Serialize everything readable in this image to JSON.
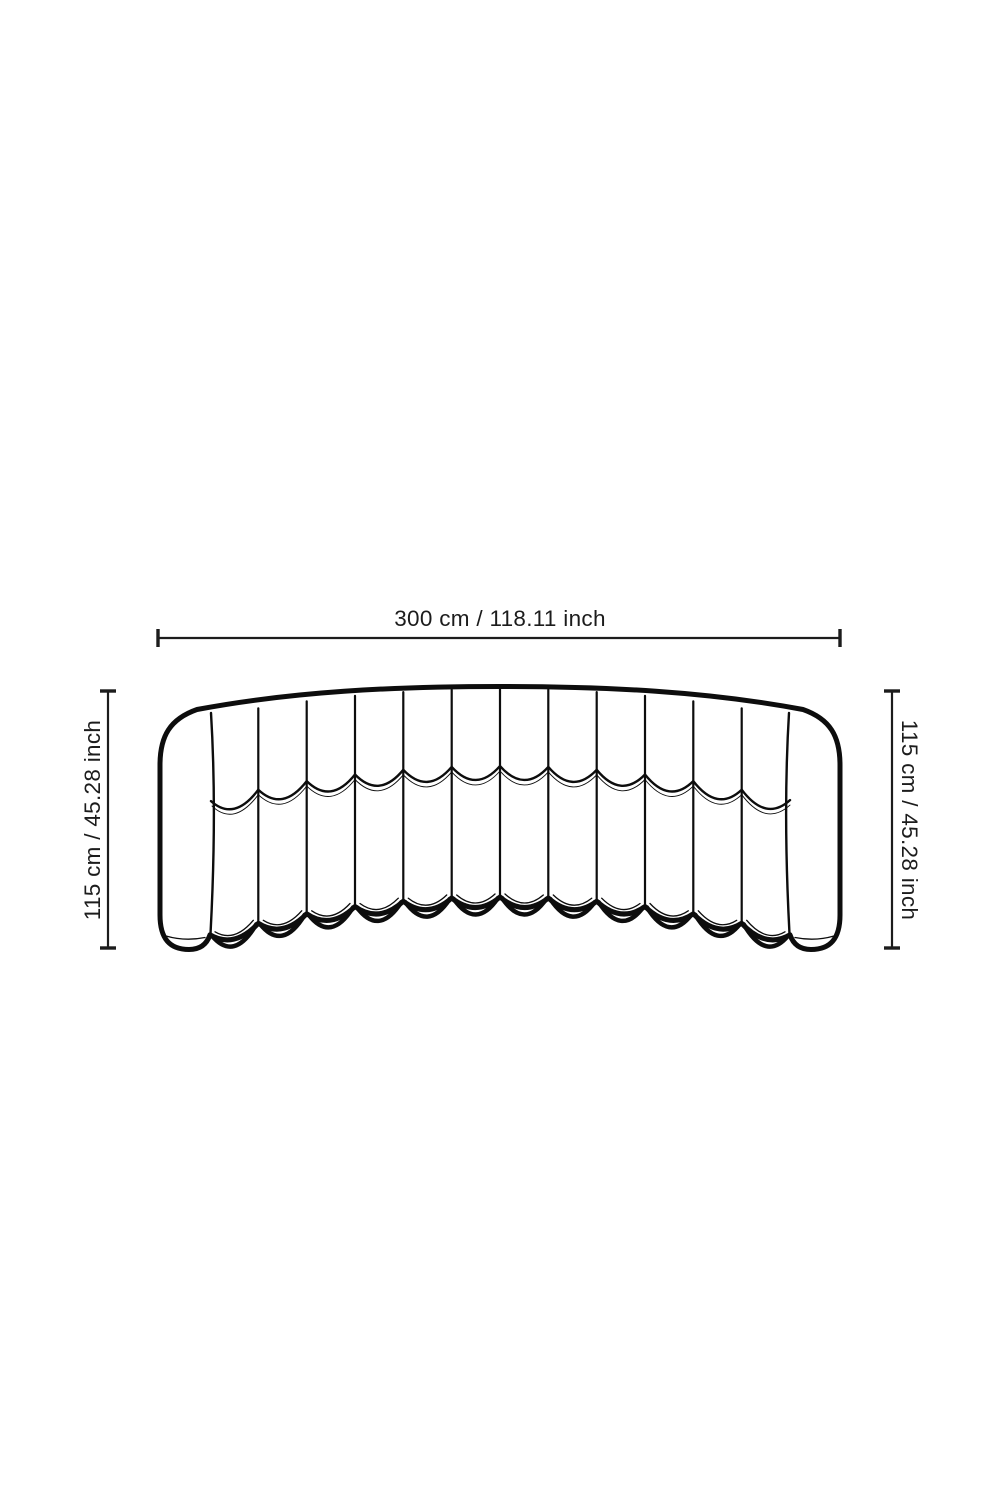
{
  "page": {
    "background_color": "#ffffff"
  },
  "colors": {
    "drawing_line": "#0d0d0d",
    "dimension_line": "#1c1c1c",
    "label_text": "#1c1c1c"
  },
  "diagram": {
    "subject": "curved-channel-sofa-front-view",
    "width_dimension": {
      "label": "300 cm / 118.11 inch"
    },
    "height_dimension_left": {
      "label": "115 cm / 45.28 inch"
    },
    "height_dimension_right": {
      "label": "115 cm / 45.28 inch"
    }
  }
}
